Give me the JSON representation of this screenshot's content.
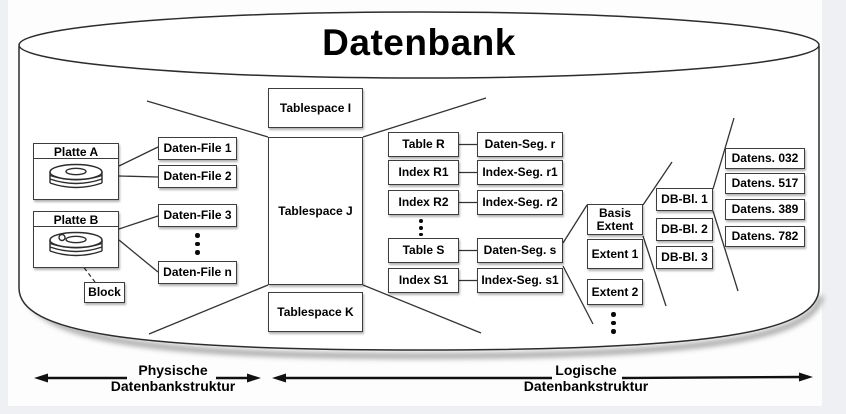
{
  "title": "Datenbank",
  "colors": {
    "line": "#333333",
    "box_border": "#3d3d3d",
    "background": "#eef0f3",
    "canvas": "#fdfdfd",
    "text": "#000000"
  },
  "physical": {
    "disk_a": {
      "label": "Platte A"
    },
    "disk_b": {
      "label": "Platte B"
    },
    "block_label": "Block",
    "files": [
      "Daten-File 1",
      "Daten-File 2",
      "Daten-File 3",
      "Daten-File n"
    ]
  },
  "tablespaces": [
    "Tablespace I",
    "Tablespace J",
    "Tablespace K"
  ],
  "segments": [
    {
      "object": "Table R",
      "segment": "Daten-Seg. r"
    },
    {
      "object": "Index R1",
      "segment": "Index-Seg. r1"
    },
    {
      "object": "Index R2",
      "segment": "Index-Seg. r2"
    },
    {
      "object": "Table S",
      "segment": "Daten-Seg. s"
    },
    {
      "object": "Index S1",
      "segment": "Index-Seg. s1"
    }
  ],
  "extents": [
    "Basis Extent",
    "Extent 1",
    "Extent 2"
  ],
  "db_blocks": [
    "DB-Bl. 1",
    "DB-Bl. 2",
    "DB-Bl. 3"
  ],
  "records": [
    "Datens. 032",
    "Datens. 517",
    "Datens. 389",
    "Datens. 782"
  ],
  "axes": {
    "physical": {
      "line1": "Physische",
      "line2": "Datenbankstruktur"
    },
    "logical": {
      "line1": "Logische",
      "line2": "Datenbankstruktur"
    }
  }
}
